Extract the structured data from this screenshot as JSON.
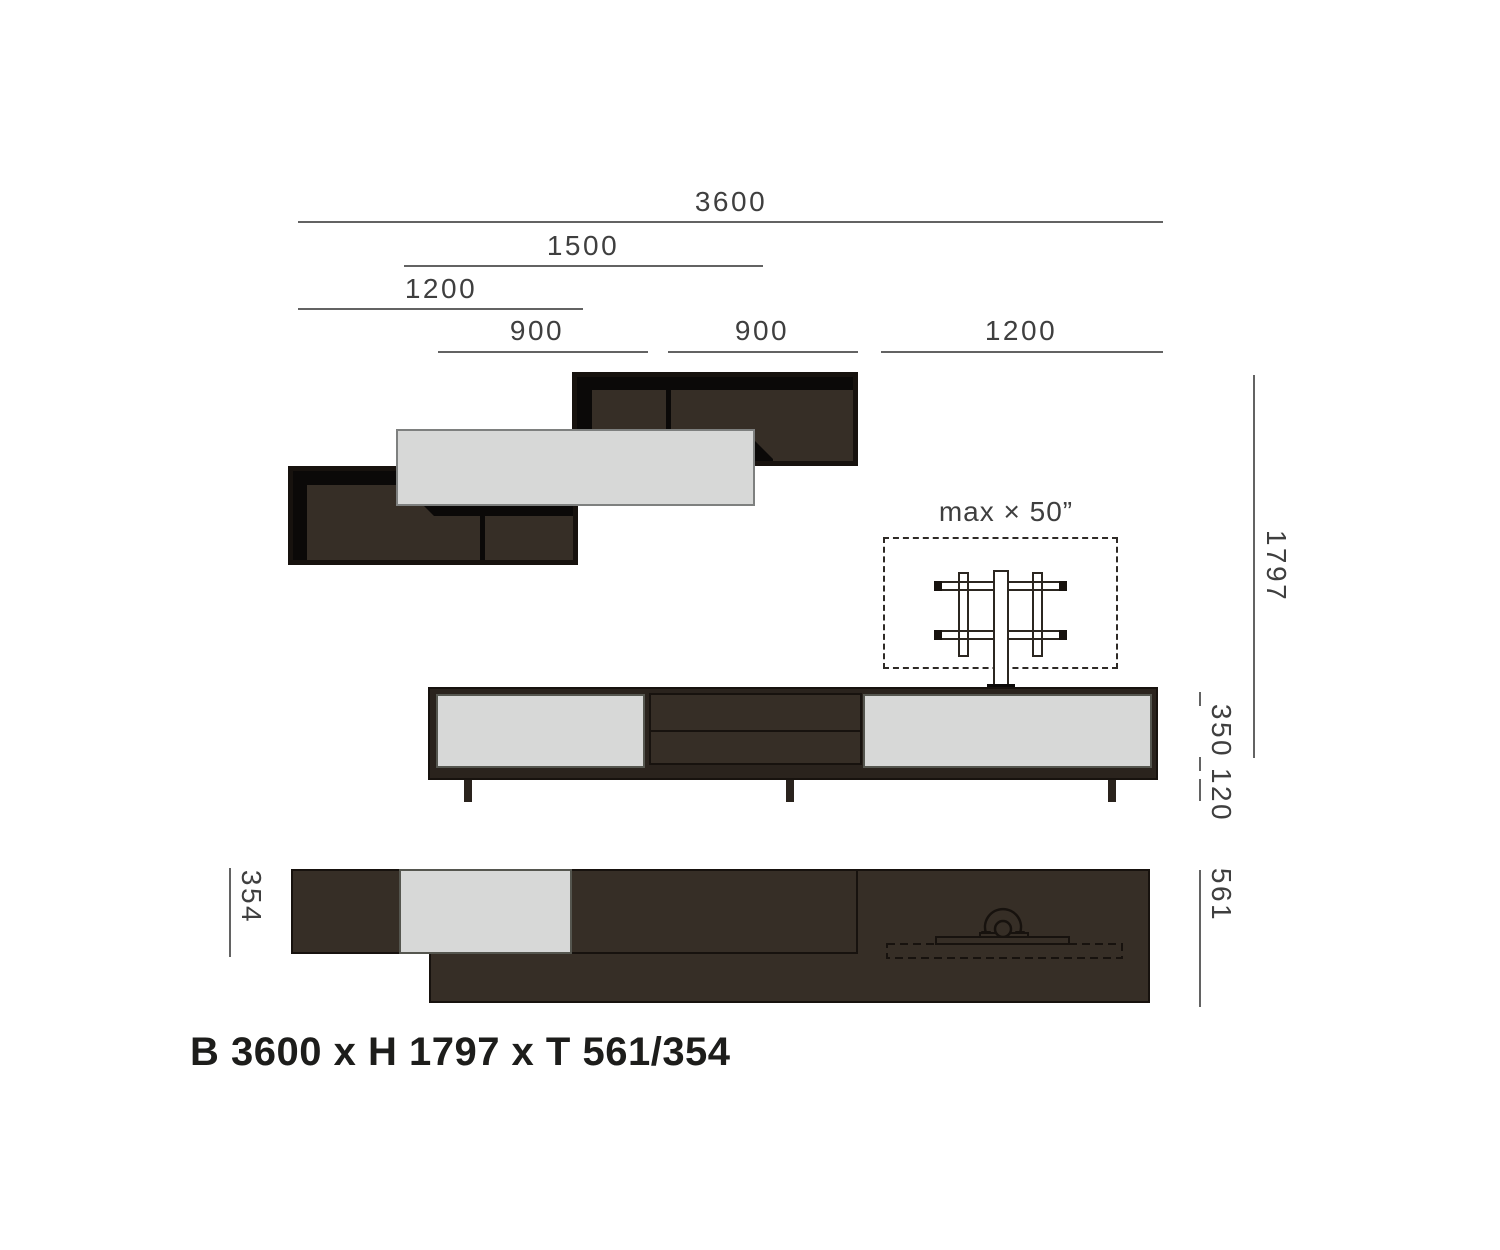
{
  "caption": "B 3600 x H 1797 x T 561/354",
  "tv": {
    "max_size_label": "max × 50”"
  },
  "dimensions": {
    "top": [
      {
        "name": "total-width",
        "value": "3600"
      },
      {
        "name": "gray-cabinet-width",
        "value": "1500"
      },
      {
        "name": "lower-shelf-width",
        "value": "1200"
      },
      {
        "name": "compartment-left",
        "value": "900"
      },
      {
        "name": "compartment-right",
        "value": "900"
      },
      {
        "name": "upper-shelf-width",
        "value": "1200"
      }
    ],
    "right": {
      "total_height": "1797",
      "lowboard_body": "350",
      "legs_height": "120",
      "depth_max": "561"
    },
    "left": {
      "depth_min": "354"
    }
  },
  "colors": {
    "bg": "#ffffff",
    "line": "#636363",
    "dim-text": "#3f3f3f",
    "frame": "#2a231d",
    "frame-dark": "#17120e",
    "wood": "#362e26",
    "shadow": "#0b0908",
    "panel-gray": "#d7d8d7",
    "title-text": "#1d1d1b"
  }
}
